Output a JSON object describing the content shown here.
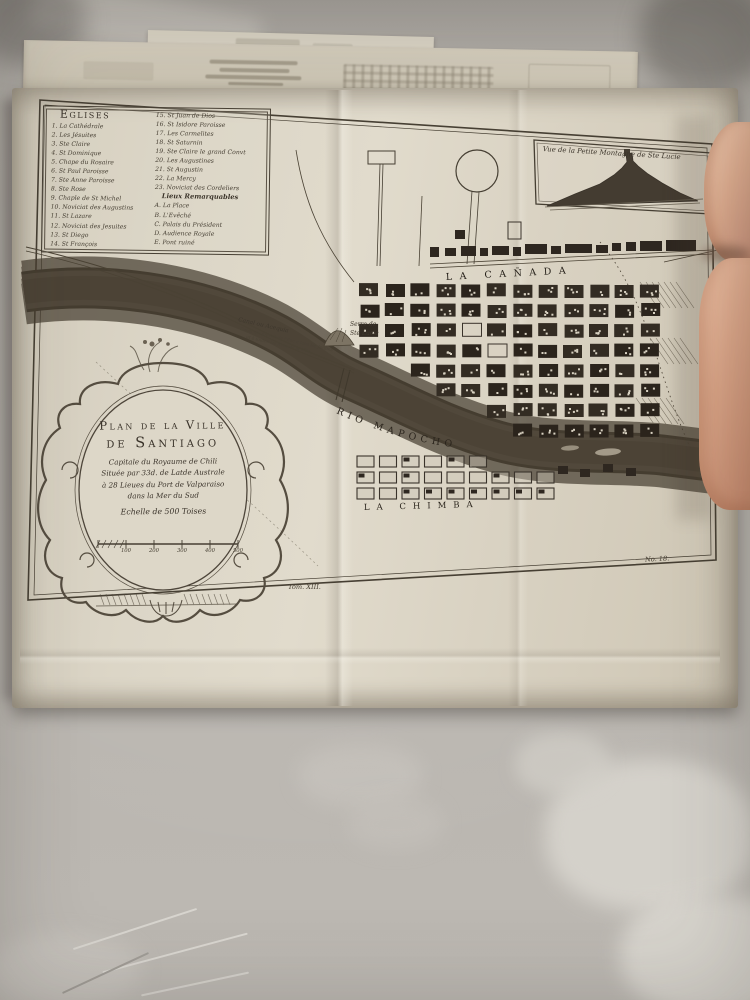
{
  "palette": {
    "table": "#b8b4ae",
    "paper": "#dcd6c7",
    "ink": "#3e372d",
    "flesh": "#d9a487"
  },
  "map": {
    "legend": {
      "title": "Eglises",
      "left": [
        "1. La Cathédrale",
        "2. Les Jésuites",
        "3. Ste Claire",
        "4. St Dominique",
        "5. Chape du Rosaire",
        "6. St Paul Paroisse",
        "7. Ste Anne Paroisse",
        "8. Ste Rose",
        "9. Chaple de St Michel",
        "10. Noviciat des Augustins",
        "11. St Lazare",
        "12. Noviciat des Jesuites",
        "13. St Diego",
        "14. St François"
      ],
      "right": [
        "15. St Juan de Dios",
        "16. St Isidore Paroisse",
        "17. Les Carmelites",
        "18. St Saturnin",
        "19. Ste Claire le grand Convt",
        "20. Les Augustines",
        "21. St Augustin",
        "22. La Mercy",
        "23. Noviciat des Cordeliers"
      ],
      "remarkables_title": "Lieux Remarquables",
      "remarkables": [
        "A. La Place",
        "B. L'Evêché",
        "C. Palais du Président",
        "D. Audience Royale",
        "E. Pont ruiné"
      ]
    },
    "inset": {
      "title": "Vue de la Petite Montagne de Ste Lucie"
    },
    "cartouche": {
      "title_line1": "Plan de la Ville",
      "title_line2": "de Santiago",
      "subtitle": [
        "Capitale du Royaume de Chili",
        "Située par 33d. de Latde Australe",
        "à 28 Lieues du Port de Valparaiso",
        "dans la Mer du Sud"
      ],
      "scale_label": "Echelle de 500 Toises",
      "scale_ticks": [
        "100",
        "200",
        "300",
        "400",
        "500"
      ]
    },
    "labels": {
      "canada": "LA CAÑADA",
      "rio": "RIO MAPOCHO",
      "chimba": "LA CHIMBA",
      "serre_line1": "Serre de",
      "serre_line2": "Ste Lucie",
      "canal_title": "Canal ou Acequia",
      "canal_note1": "Canal qui fournit de l'Eau à tous les Jardins",
      "canal_note2": "et à toutes les Rues de la Ville",
      "tome": "Tom. XIII.",
      "plate": "No. 18."
    }
  }
}
